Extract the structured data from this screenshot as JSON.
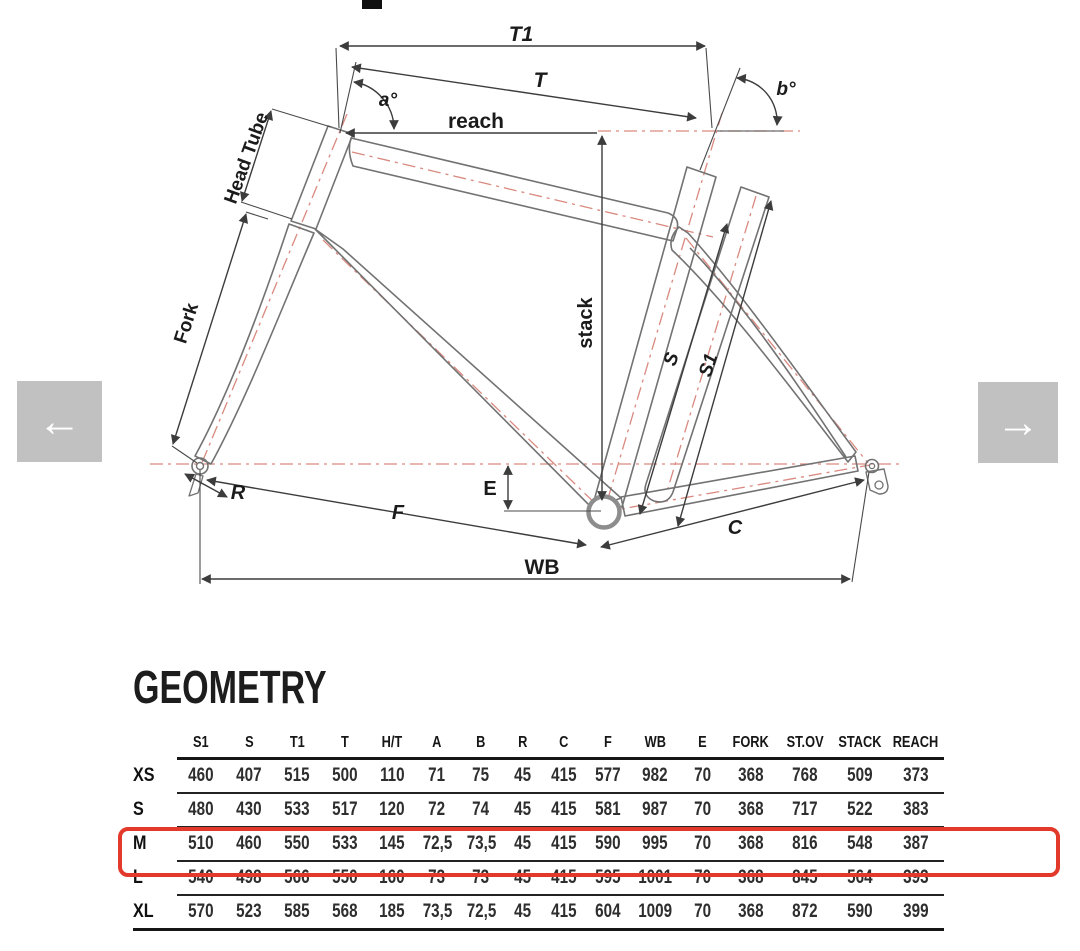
{
  "page": {
    "background": "#ffffff"
  },
  "carousel": {
    "prev_icon": "←",
    "next_icon": "→"
  },
  "diagram": {
    "labels": {
      "t1": "T1",
      "t": "T",
      "angle_a": "a°",
      "angle_b": "b°",
      "reach": "reach",
      "head_tube": "Head Tube",
      "fork": "Fork",
      "stack": "stack",
      "s": "S",
      "s1": "S1",
      "r": "R",
      "e": "E",
      "f": "F",
      "c": "C",
      "wb": "WB"
    },
    "colors": {
      "frame_outline": "#727272",
      "dimension_line": "#3c3c3c",
      "centerline_red": "#d9897f"
    }
  },
  "geometry_section": {
    "title": "GEOMETRY",
    "table": {
      "headers": [
        "",
        "S1",
        "S",
        "T1",
        "T",
        "H/T",
        "A",
        "B",
        "R",
        "C",
        "F",
        "WB",
        "E",
        "FORK",
        "ST.OV",
        "STACK",
        "REACH"
      ],
      "rows": [
        {
          "label": "XS",
          "highlighted": false,
          "values": [
            "460",
            "407",
            "515",
            "500",
            "110",
            "71",
            "75",
            "45",
            "415",
            "577",
            "982",
            "70",
            "368",
            "768",
            "509",
            "373"
          ]
        },
        {
          "label": "S",
          "highlighted": false,
          "values": [
            "480",
            "430",
            "533",
            "517",
            "120",
            "72",
            "74",
            "45",
            "415",
            "581",
            "987",
            "70",
            "368",
            "717",
            "522",
            "383"
          ]
        },
        {
          "label": "M",
          "highlighted": true,
          "values": [
            "510",
            "460",
            "550",
            "533",
            "145",
            "72,5",
            "73,5",
            "45",
            "415",
            "590",
            "995",
            "70",
            "368",
            "816",
            "548",
            "387"
          ]
        },
        {
          "label": "L",
          "highlighted": false,
          "values": [
            "540",
            "498",
            "566",
            "550",
            "160",
            "73",
            "73",
            "45",
            "415",
            "595",
            "1001",
            "70",
            "368",
            "845",
            "564",
            "393"
          ]
        },
        {
          "label": "XL",
          "highlighted": false,
          "values": [
            "570",
            "523",
            "585",
            "568",
            "185",
            "73,5",
            "72,5",
            "45",
            "415",
            "604",
            "1009",
            "70",
            "368",
            "872",
            "590",
            "399"
          ]
        }
      ],
      "highlight_color": "#e2392b"
    }
  }
}
